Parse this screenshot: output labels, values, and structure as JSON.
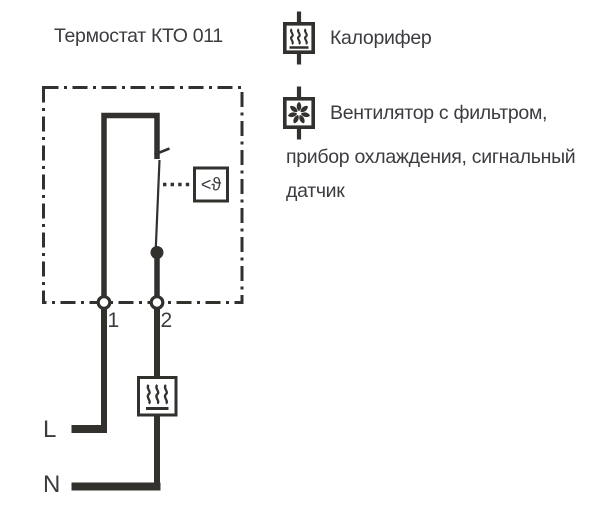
{
  "page": {
    "title": "Термостат КТО 011"
  },
  "colors": {
    "line": "#32312e",
    "text": "#3c3b40",
    "background": "#ffffff"
  },
  "diagram": {
    "terminal_labels": [
      "1",
      "2"
    ],
    "sensor_label": "<ϑ",
    "phase_label": "L",
    "neutral_label": "N"
  },
  "legend": {
    "items": [
      {
        "icon": "heater-icon",
        "lines": [
          "Калорифер"
        ]
      },
      {
        "icon": "fan-icon",
        "lines": [
          "Вентилятор с фильтром,",
          "прибор охлаждения, сигнальный",
          "датчик"
        ]
      }
    ]
  }
}
